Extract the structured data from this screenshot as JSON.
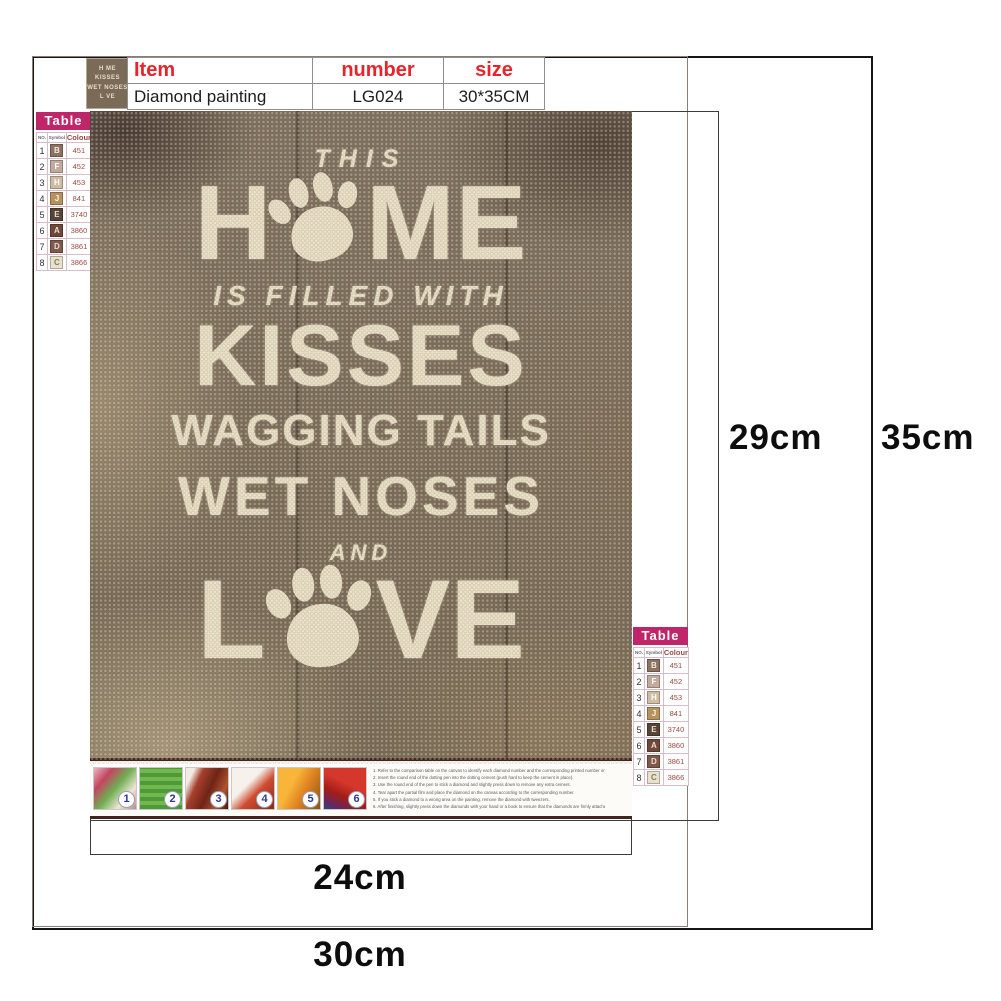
{
  "product_header": {
    "thumbnail_lines": [
      "H ME",
      "KISSES",
      "WET NOSES",
      "L VE"
    ],
    "table": {
      "headers": [
        "Item",
        "number",
        "size"
      ],
      "row": [
        "Diamond painting",
        "LG024",
        "30*35CM"
      ]
    }
  },
  "legend": {
    "title": "Table",
    "columns": [
      "NO.",
      "Symbol",
      "Colour"
    ],
    "rows": [
      {
        "no": "1",
        "symbol": "B",
        "code": "451",
        "swatch": "#8d7262",
        "letter": "#f2e9da"
      },
      {
        "no": "2",
        "symbol": "F",
        "code": "452",
        "swatch": "#c3aa9c",
        "letter": "#ffffff"
      },
      {
        "no": "3",
        "symbol": "H",
        "code": "453",
        "swatch": "#d0bca3",
        "letter": "#ffffff"
      },
      {
        "no": "4",
        "symbol": "J",
        "code": "841",
        "swatch": "#b5925f",
        "letter": "#fff7e2"
      },
      {
        "no": "5",
        "symbol": "E",
        "code": "3740",
        "swatch": "#574439",
        "letter": "#e8ddcf"
      },
      {
        "no": "6",
        "symbol": "A",
        "code": "3860",
        "swatch": "#6f4839",
        "letter": "#e8ddcf"
      },
      {
        "no": "7",
        "symbol": "D",
        "code": "3861",
        "swatch": "#80594a",
        "letter": "#e8ddcf"
      },
      {
        "no": "8",
        "symbol": "C",
        "code": "3866",
        "swatch": "#e9e1cb",
        "letter": "#8a7a55"
      }
    ]
  },
  "canvas_art": {
    "line_this": "THIS",
    "home_h": "H",
    "home_m": "M",
    "home_e": "E",
    "line_filled": "IS FILLED WITH",
    "line_kisses": "KISSES",
    "line_wagging": "WAGGING TAILS",
    "line_wet": "WET NOSES",
    "line_and": "AND",
    "love_l": "L",
    "love_v": "V",
    "love_e": "E"
  },
  "steps": {
    "numbers": [
      "1",
      "2",
      "3",
      "4",
      "5",
      "6"
    ]
  },
  "instructions": [
    "1. Refer to the comparison table on the canvas to identify each diamond number and the corresponding printed number on the canvas.",
    "2. Insert the round end of the dotting pen into the dotting cement (push hard to keep the cement in place).",
    "3. Use the round end of the pen to stick a diamond and slightly press down to remove any extra cement.",
    "4. Tear apart the partial film and place the diamond on the canvas according to the corresponding number.",
    "5. If you stick a diamond to a wrong area on the painting, remove the diamond with tweezers.",
    "6. After finishing, slightly press down the diamonds with your hand or a book to ensure that the diamonds are firmly attached."
  ],
  "dimensions": {
    "design_height": "29cm",
    "canvas_height": "35cm",
    "design_width": "24cm",
    "canvas_width": "30cm"
  },
  "colors": {
    "accent_red": "#e8242b",
    "banner_magenta": "#bf2569",
    "canvas_brown": "#7e6f5f",
    "canvas_cream": "#eae0c6",
    "badge_blue": "#2d3a8c"
  }
}
